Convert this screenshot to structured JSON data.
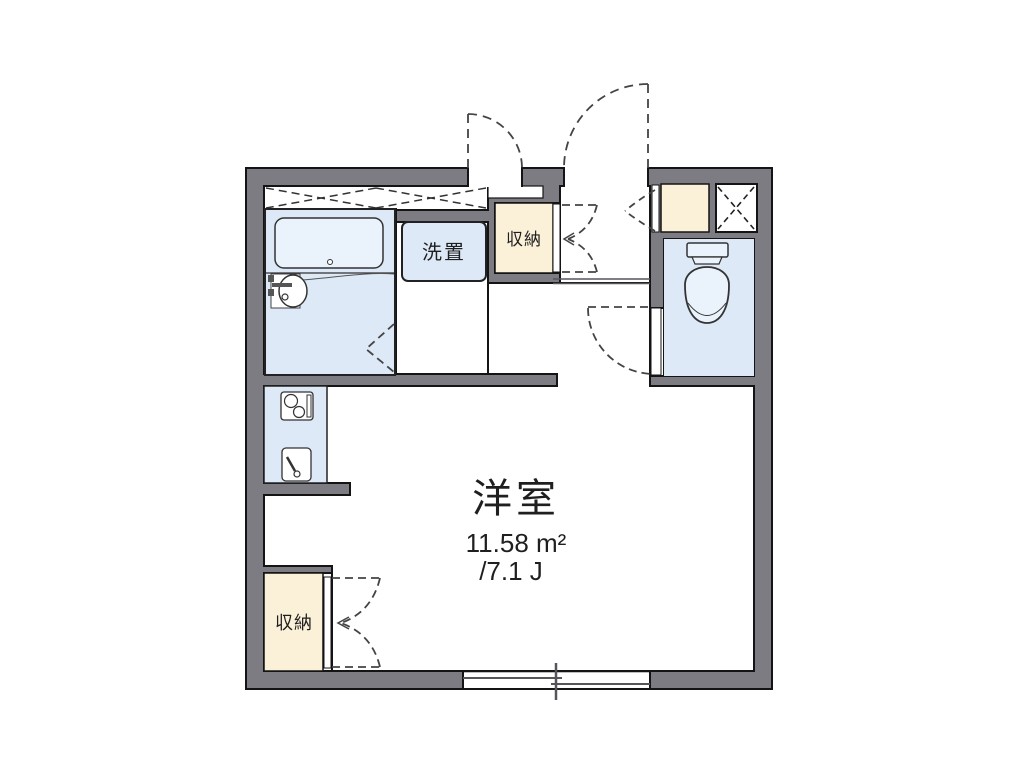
{
  "plan": {
    "type": "floor-plan",
    "rooms": {
      "main": {
        "name": "洋室",
        "area_m2": "11.58 m²",
        "area_tatami": "/7.1 J"
      },
      "storage_top": {
        "label": "収納"
      },
      "storage_bottom": {
        "label": "収納"
      },
      "laundry": {
        "label": "洗置"
      }
    },
    "fixtures": [
      "bathtub",
      "bathroom-sink",
      "toilet",
      "kitchen-stove",
      "kitchen-sink",
      "shoe-box",
      "pipe-shaft",
      "sliding-window",
      "entry-door",
      "storage-bifold-doors"
    ],
    "palette": {
      "wall_gray": "#7c7c82",
      "outline_black": "#141414",
      "fixture_blue": "#dde9f7",
      "fixture_blue_light": "#eaf2fb",
      "storage_cream": "#fbf0d8",
      "floor_white": "#ffffff",
      "dash_gray": "#444444"
    }
  }
}
